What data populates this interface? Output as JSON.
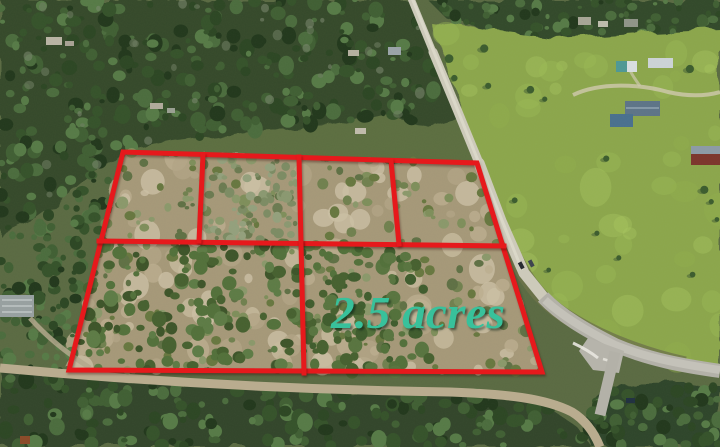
{
  "photo": {
    "kind": "aerial drone photograph",
    "caption": "Wooded land parcels outlined in red beside a rural gravel road, green pasture with barns to the east, paved road intersection at bottom right"
  },
  "overlay": {
    "acreage_label": "2.5 acres",
    "outline": {
      "name": "parcel-boundary",
      "points": "123,152 477,163 542,372 69,370"
    },
    "lines": [
      {
        "name": "mid-horizontal-divider",
        "points": "99,241 504,246"
      },
      {
        "name": "top-row-divider-1",
        "points": "203,155 199,241"
      },
      {
        "name": "top-row-divider-2",
        "points": "299,157 301,243"
      },
      {
        "name": "top-row-divider-3",
        "points": "391,161 399,244"
      },
      {
        "name": "bottom-row-divider",
        "points": "301,243 304,373"
      }
    ]
  },
  "colors": {
    "outline-red": "#e6191c",
    "label-teal": "#38c19b",
    "forest-dark": "#2e4524",
    "pasture-green": "#8ba64c",
    "cleared-tan": "#a59878",
    "scrub-olive": "#5c6e40",
    "gravel-road": "#cdcaba",
    "paved-road": "#b3b1a8",
    "dirt-road": "#b9ac8e"
  }
}
